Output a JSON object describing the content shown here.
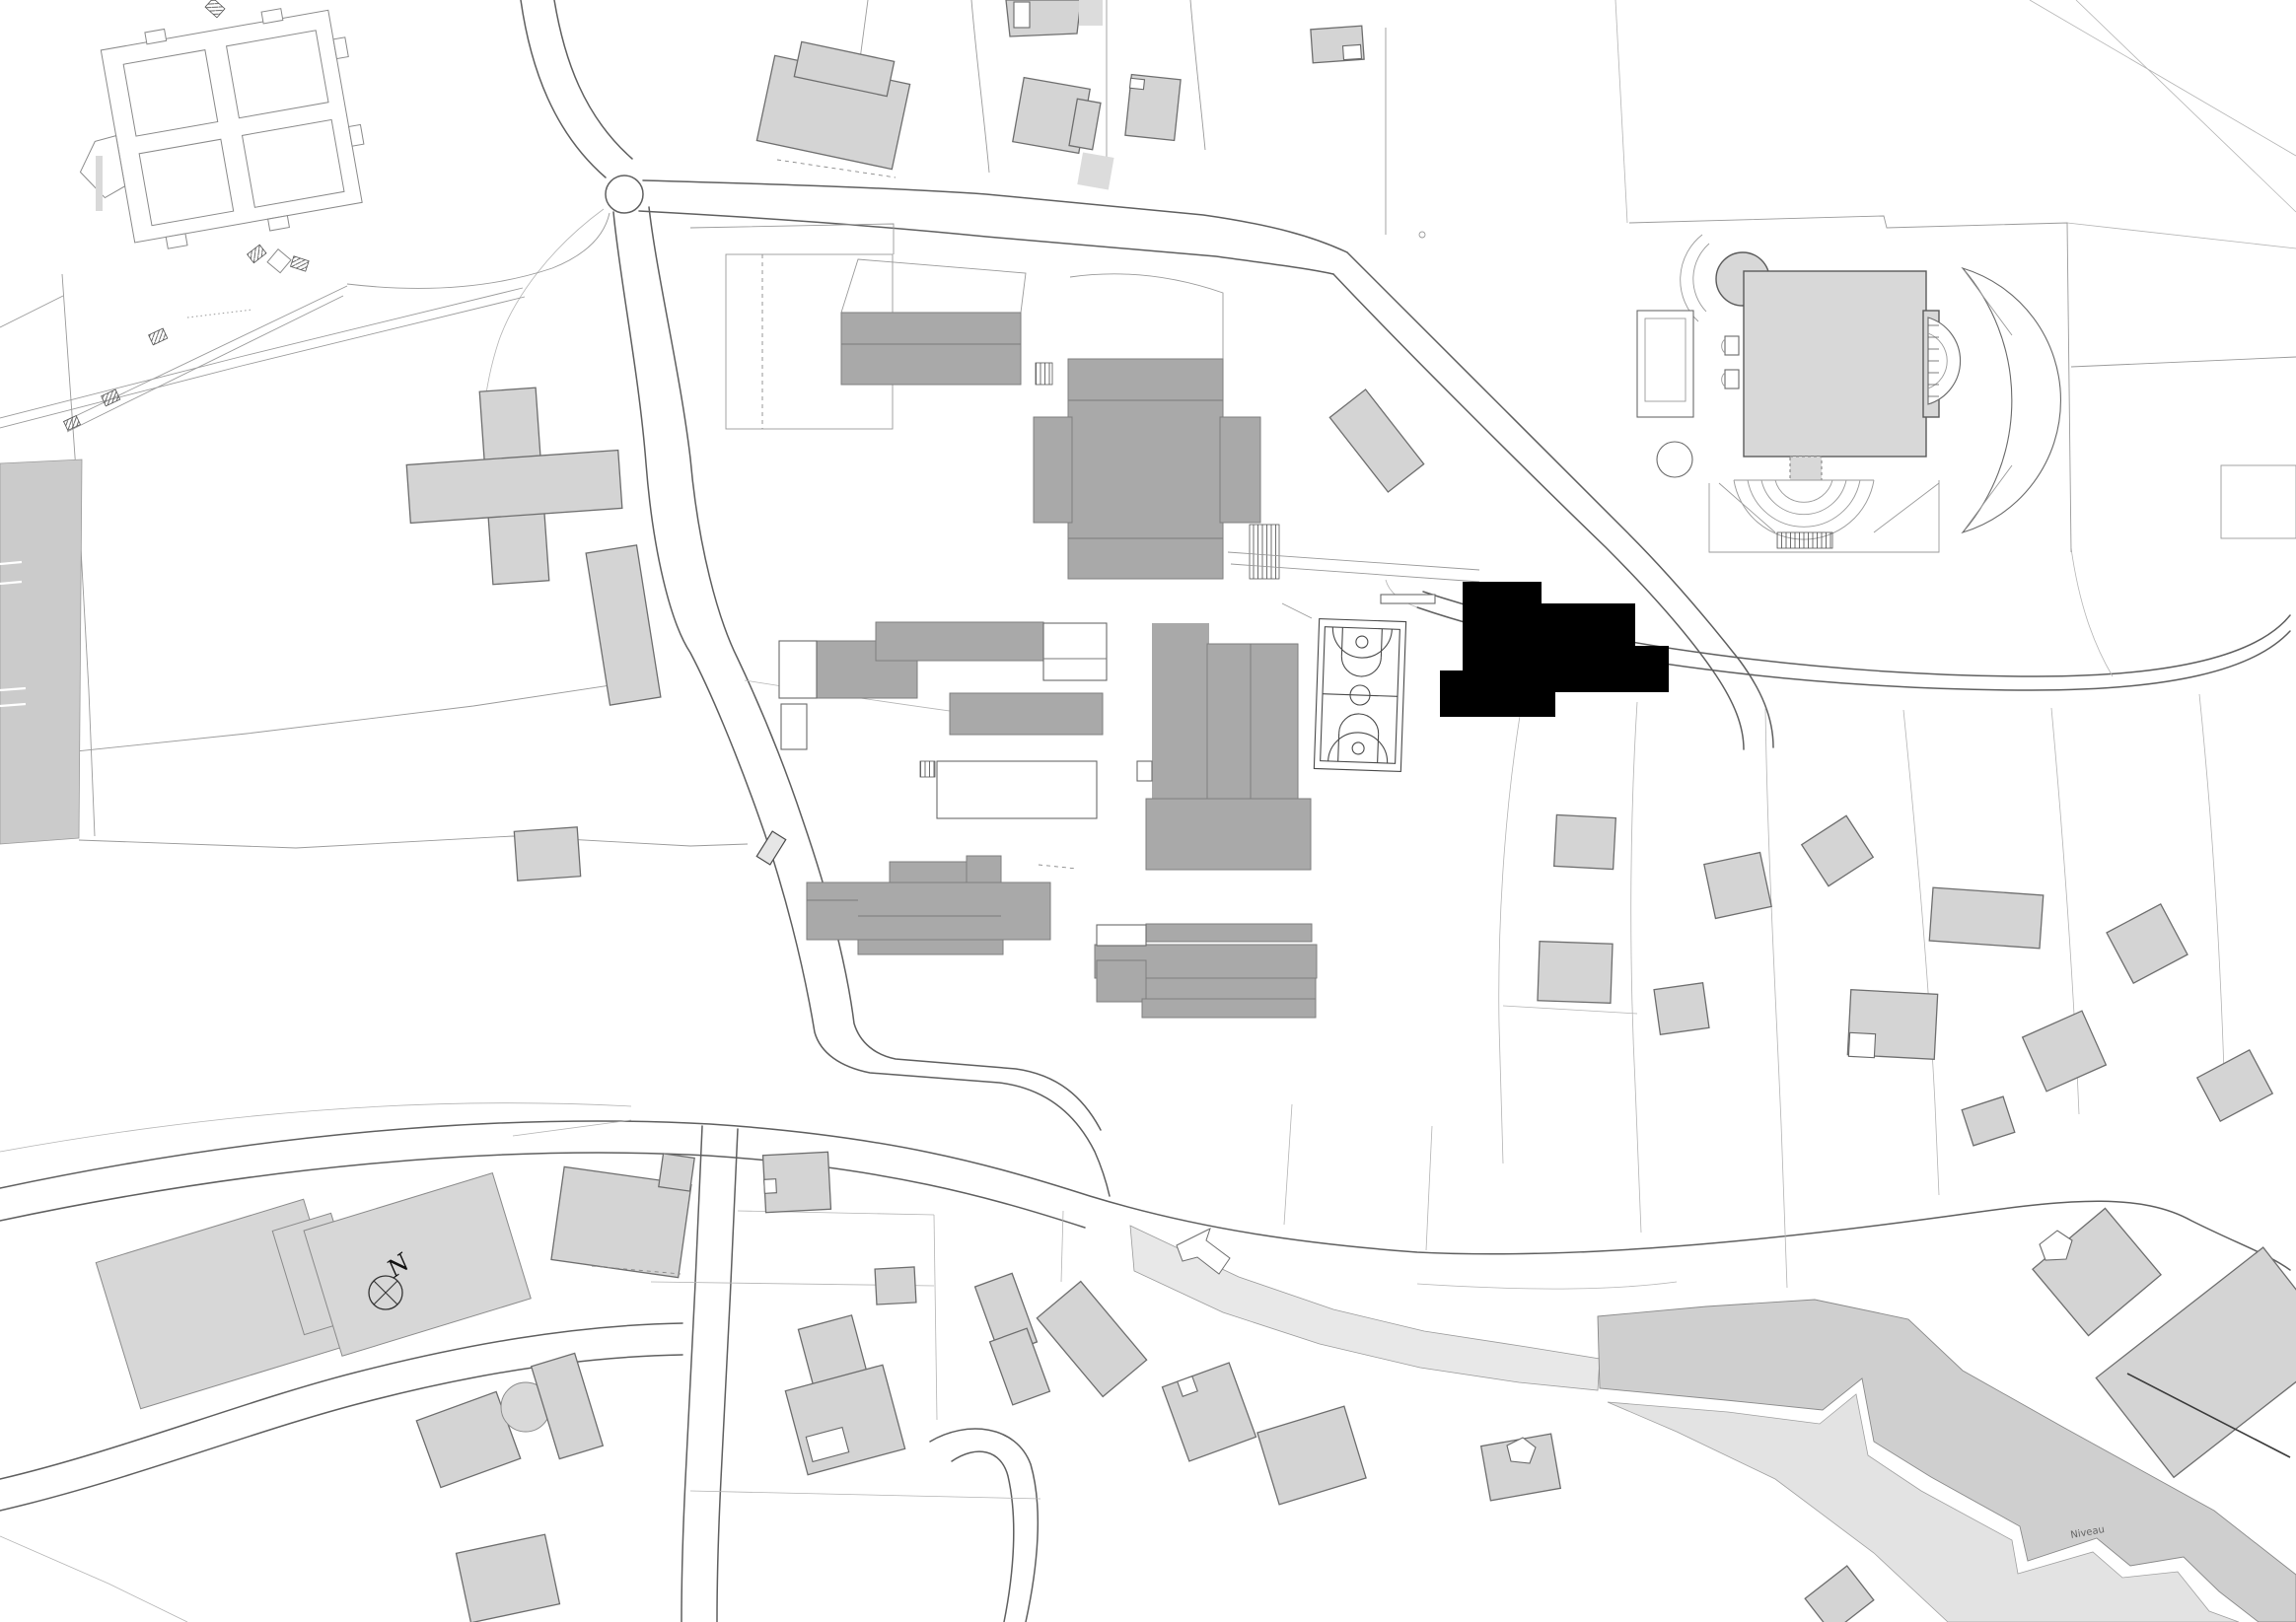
{
  "map": {
    "kind": "architectural-site-plan",
    "labels": {
      "north_arrow": "N",
      "stream": "Niveau"
    },
    "colors": {
      "background": "#ffffff",
      "building_light": "#d4d4d4",
      "building_light_unlined": "#dcdcdc",
      "building_mid_gray": "#a9a9a9",
      "building_highlight_black": "#000000",
      "church_building": "#d8d8d8",
      "large_slab_building": "#d7d7d7",
      "path_band": "#e8e8e8",
      "embankment_band": "#cfcfcf",
      "field_band": "#e3e3e3",
      "road_line": "#5f5f5f",
      "parcel_line": "#9a9a9a"
    }
  }
}
